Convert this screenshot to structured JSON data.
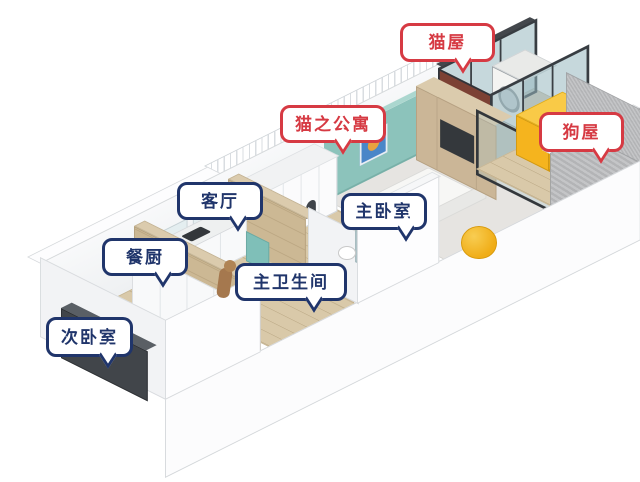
{
  "labels": [
    {
      "id": "cat-house",
      "text": "猫屋",
      "color": "red"
    },
    {
      "id": "cat-apartment",
      "text": "猫之公寓",
      "color": "red"
    },
    {
      "id": "dog-house",
      "text": "狗屋",
      "color": "red"
    },
    {
      "id": "living-room",
      "text": "客厅",
      "color": "blue"
    },
    {
      "id": "dining-kitchen",
      "text": "餐厨",
      "color": "blue"
    },
    {
      "id": "secondary-bedroom",
      "text": "次卧室",
      "color": "blue"
    },
    {
      "id": "master-bathroom",
      "text": "主卫生间",
      "color": "blue"
    },
    {
      "id": "master-bedroom",
      "text": "主卧室",
      "color": "blue"
    }
  ],
  "colors": {
    "pet_label_red": "#d63a43",
    "room_label_navy": "#20356b",
    "teal_accent_wall": "#8cc3bb",
    "wood_floor": "#d9c9a9",
    "dog_house_yellow": "#f5b41e",
    "bean_bag_yellow": "#f0ad17",
    "balcony_rail_gray": "#b8b9bb"
  }
}
